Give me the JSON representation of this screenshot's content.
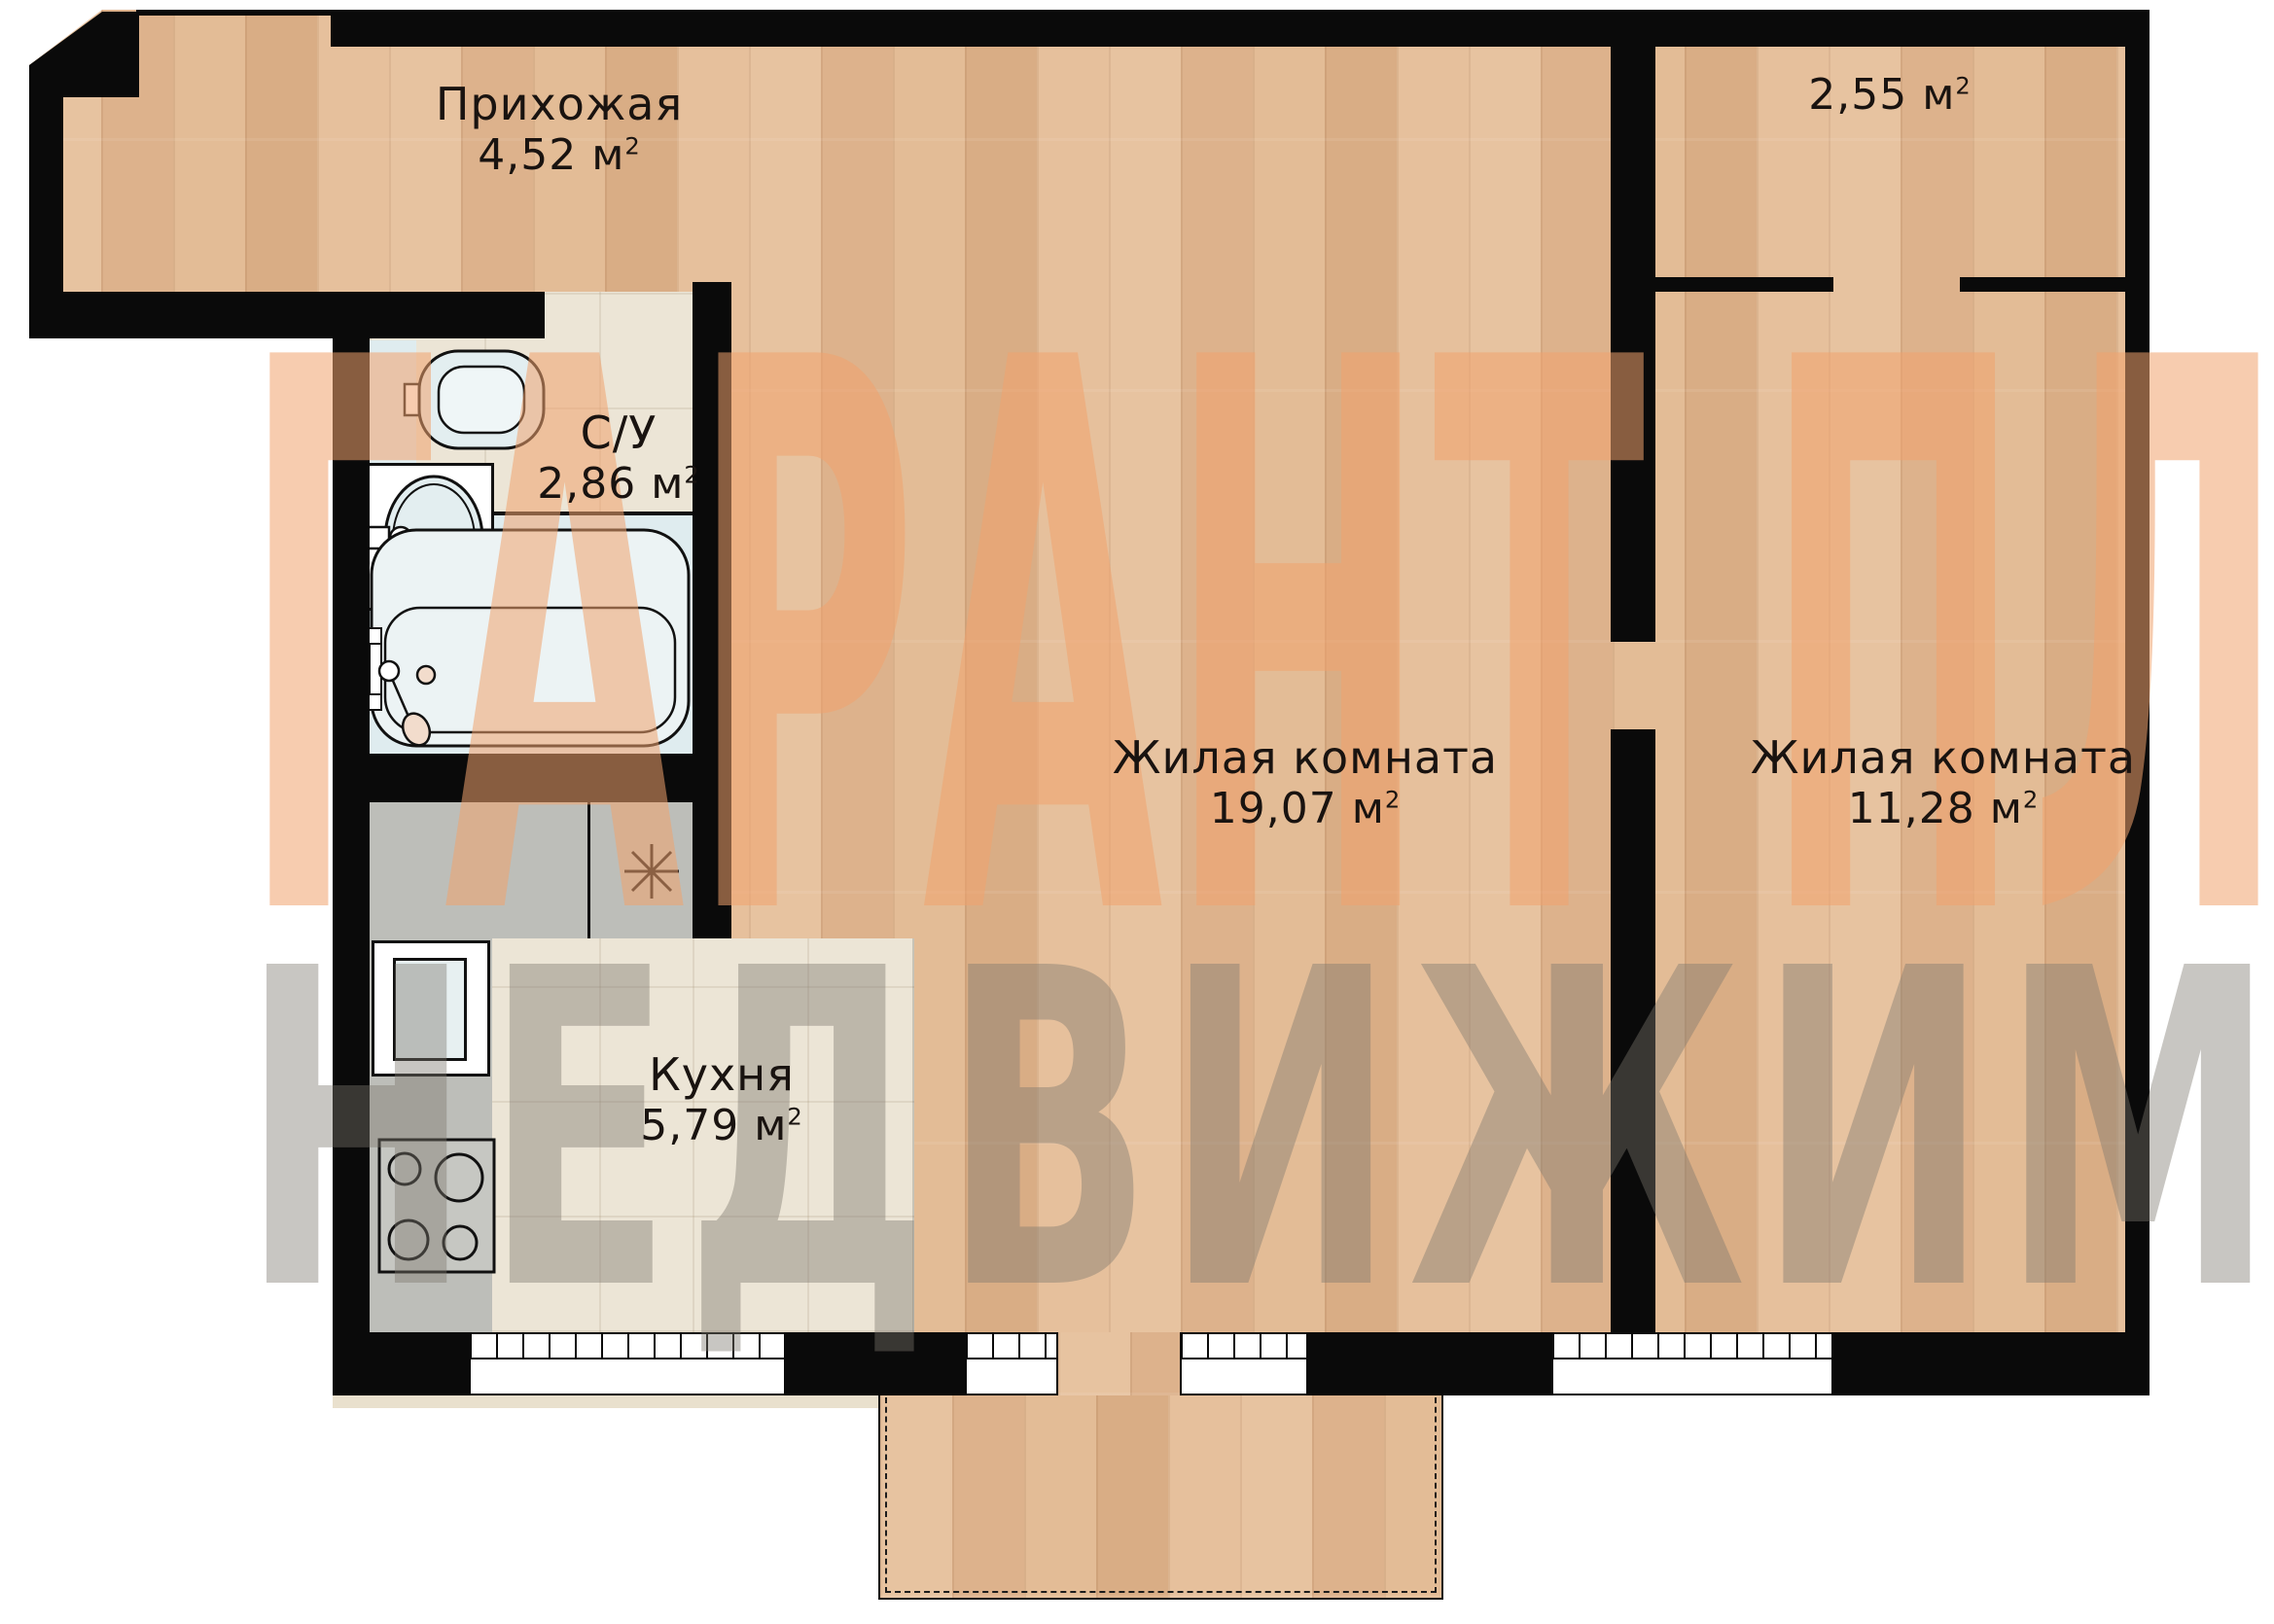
{
  "unit": {
    "symbol": "м",
    "exponent": "2"
  },
  "rooms": {
    "hallway": {
      "name": "Прихожая",
      "area": "4,52"
    },
    "wc": {
      "name": "С/У",
      "area": "2,86"
    },
    "kitchen": {
      "name": "Кухня",
      "area": "5,79"
    },
    "living_room_1": {
      "name": "Жилая комната",
      "area": "19,07"
    },
    "living_room_2": {
      "name": "Жилая комната",
      "area": "11,28"
    },
    "loggia": {
      "area": "2,55"
    }
  },
  "watermark": {
    "title": "ГАРАНТ ПЛЮС",
    "subtitle": "НЕДВИЖИМОСТЬ"
  },
  "colors": {
    "wall": "#0a0a0a",
    "wood_floor": "#e3bd98",
    "tile_floor": "#ece5d6",
    "fixture_fill": "#dfecef",
    "counter_gray": "#bdbeb9",
    "watermark_orange": "rgba(240,162,110,0.55)",
    "watermark_gray": "rgba(125,120,110,0.42)"
  }
}
